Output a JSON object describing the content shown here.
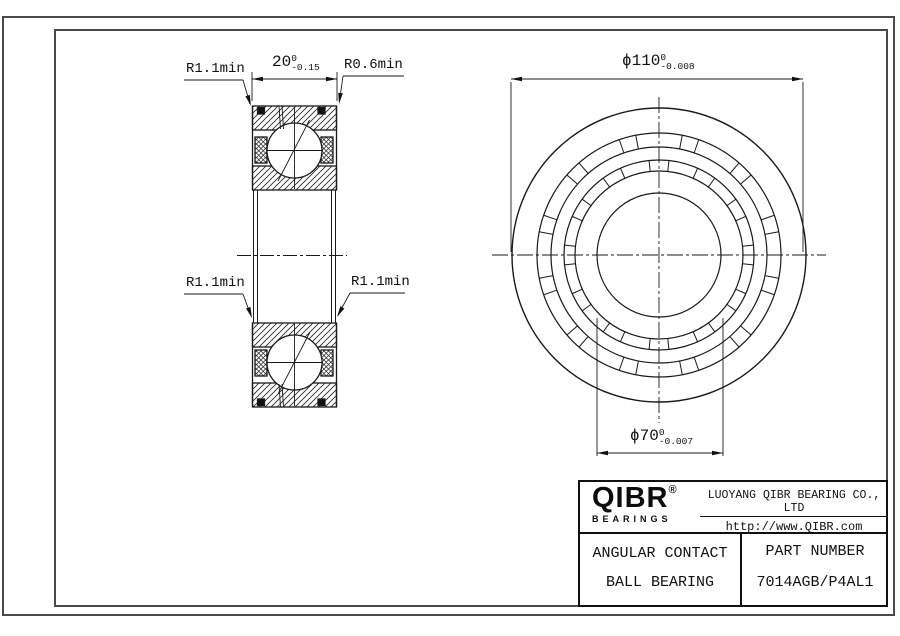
{
  "drawing": {
    "dims": {
      "width": {
        "value": "20",
        "tol_upper": "0",
        "tol_lower": "-0.15"
      },
      "od": {
        "value": "ϕ110",
        "tol_upper": "0",
        "tol_lower": "-0.008"
      },
      "bore": {
        "value": "ϕ70",
        "tol_upper": "0",
        "tol_lower": "-0.007"
      },
      "radius_top_left": "R1.1min",
      "radius_top_right": "R0.6min",
      "radius_mid_left": "R1.1min",
      "radius_mid_right": "R1.1min"
    }
  },
  "title_block": {
    "logo_text": "QIBR",
    "logo_reg": "®",
    "logo_sub": "BEARINGS",
    "company": "LUOYANG QIBR BEARING CO., LTD",
    "website": "http://www.QIBR.com",
    "product_line1": "ANGULAR CONTACT",
    "product_line2": "BALL BEARING",
    "part_label": "PART  NUMBER",
    "part_number": "7014AGB/P4AL1"
  }
}
